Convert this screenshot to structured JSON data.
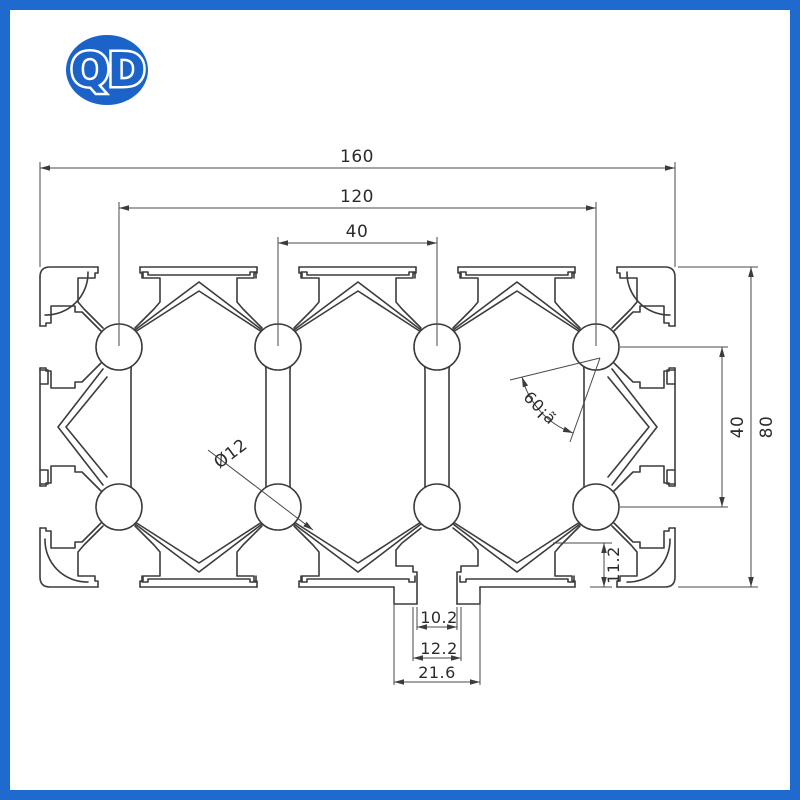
{
  "page": {
    "frame_color": "#1e6ace",
    "background": "#ffffff"
  },
  "logo": {
    "text": "QD",
    "color": "#1b63c8"
  },
  "drawing": {
    "title": "aluminium-profile-cross-section-80x160",
    "line_color": "#3c3c3c",
    "dims": {
      "width_total": "160",
      "width_inner": "120",
      "pitch_top": "40",
      "height_total": "80",
      "height_inner": "40",
      "bore": "Ø12",
      "angle": "60¡ã",
      "slot_depth": "11.2",
      "slot_opening": "10.2",
      "slot_lip": "12.2",
      "slot_cavity": "21.6"
    }
  }
}
